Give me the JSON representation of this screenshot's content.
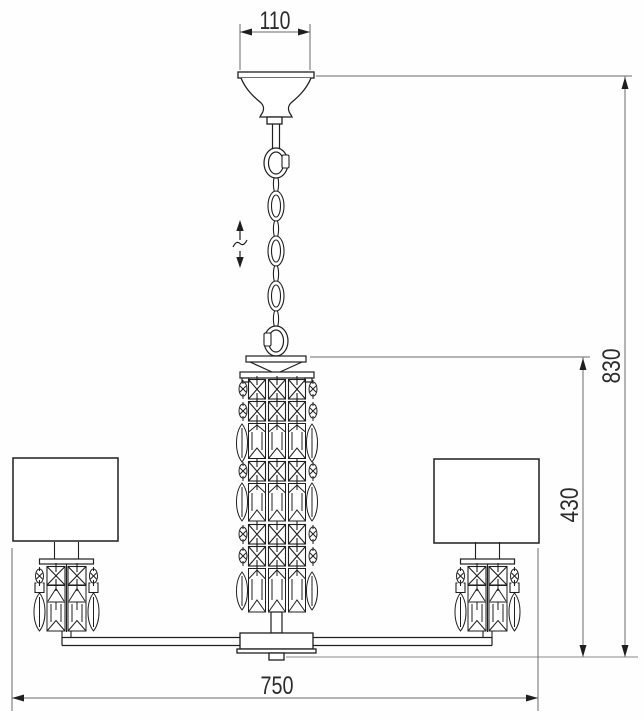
{
  "title": "Chandelier dimensional drawing",
  "dimensions": {
    "canopy_width_mm": "110",
    "overall_height_mm": "830",
    "body_height_mm": "430",
    "overall_width_mm": "750"
  },
  "symbols": {
    "height_adjust_icon": "double-headed-arrow-with-break"
  },
  "colors": {
    "drawing_line": "#1f1f1f",
    "dimension_line": "#6b6b6b",
    "text": "#2b2b2b",
    "background": "#ffffff"
  }
}
